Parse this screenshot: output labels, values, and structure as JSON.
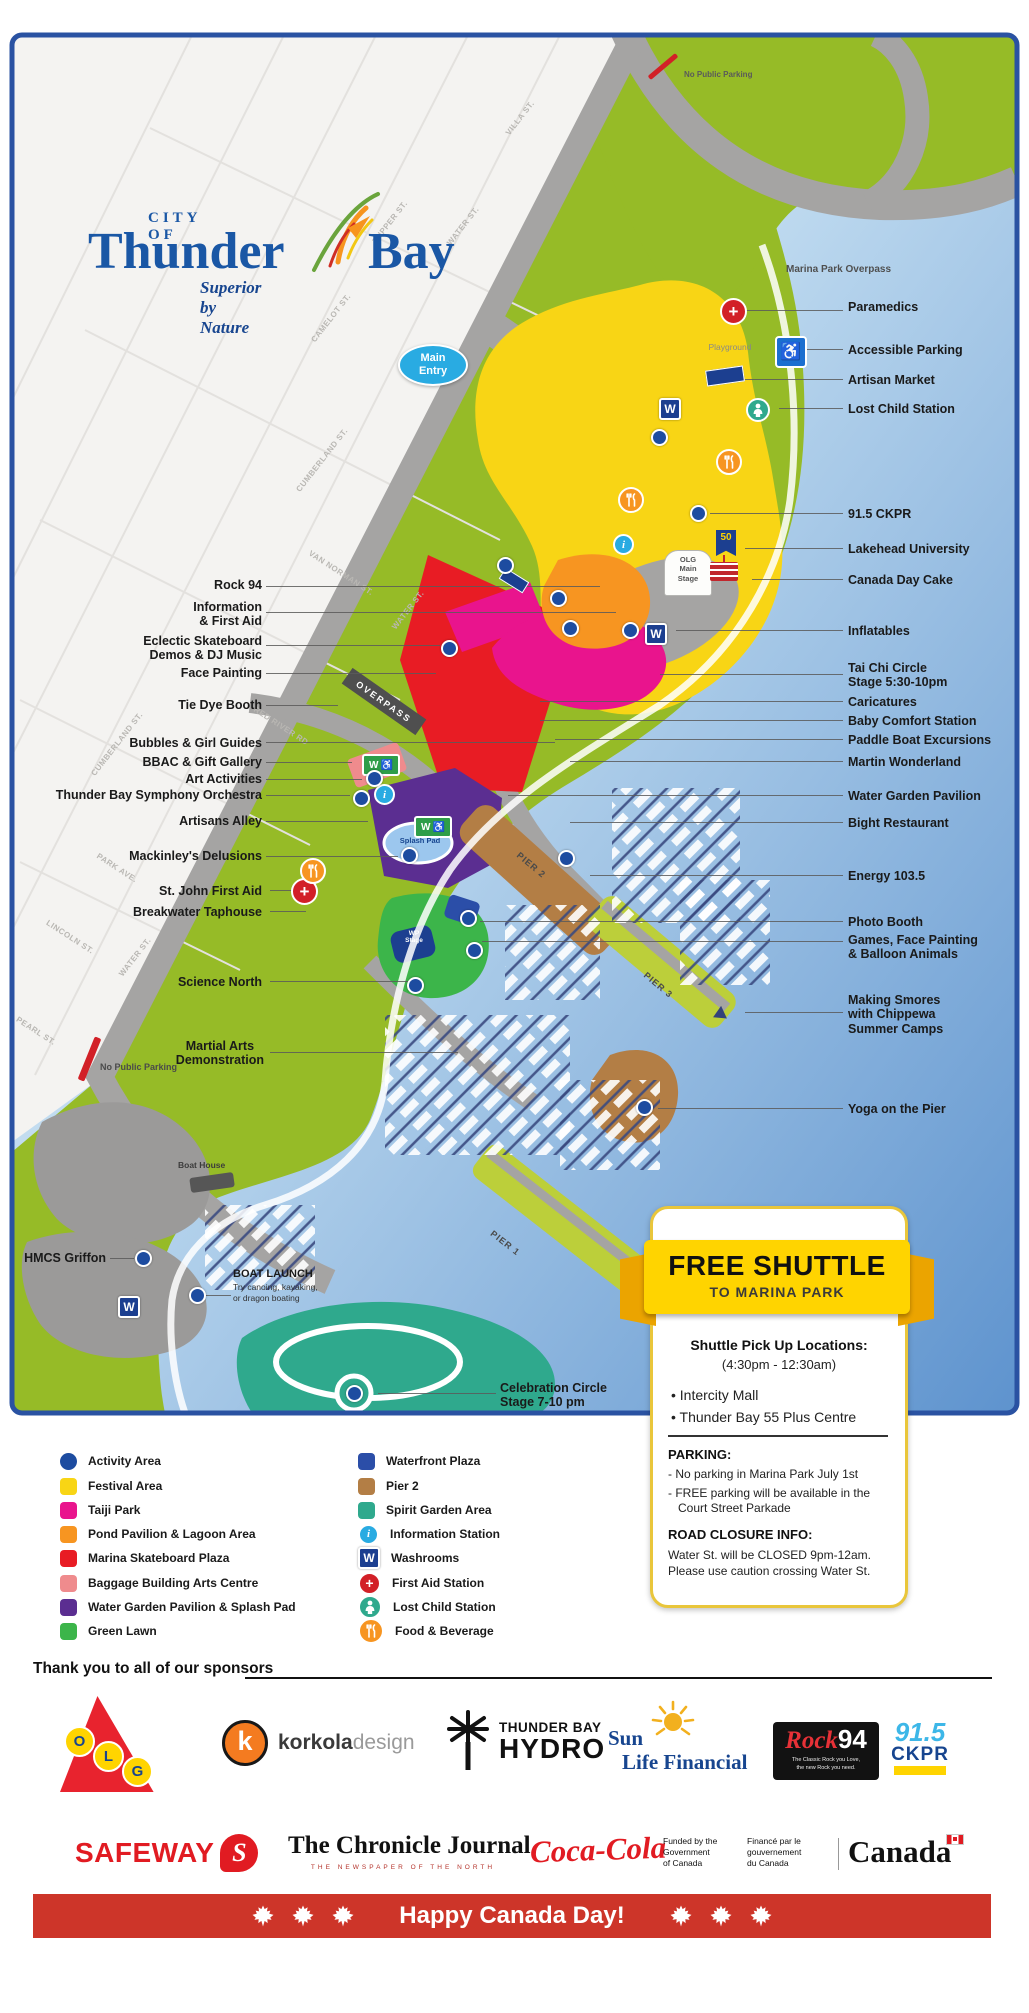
{
  "logo": {
    "city_of": "CITY OF",
    "thunder": "Thunder",
    "bay": "Bay",
    "tagline": "Superior by Nature"
  },
  "icons": {
    "washroom_letter": "W",
    "info_letter": "i",
    "accessible_symbol": "♿",
    "first_aid_symbol": "+",
    "flag_50": "50"
  },
  "map": {
    "no_public_parking_top": "No Public Parking",
    "no_public_parking_bottom": "No Public Parking",
    "marina_park_overpass": "Marina Park Overpass",
    "overpass_badge": "OVERPASS",
    "main_entry": "Main\nEntry",
    "playground": "Playground",
    "olg_main_stage": "OLG\nMain\nStage",
    "splash_pad": "Splash Pad",
    "wp_stage": "WP\nStage",
    "boat_house": "Boat House",
    "pier_1": "PIER 1",
    "pier_2": "PIER 2",
    "pier_3": "PIER 3",
    "boat_launch_title": "BOAT LAUNCH",
    "boat_launch_sub": "Try canoing, kayaking,\nor dragon boating",
    "streets": [
      "TUPPER ST.",
      "WATER ST.",
      "VILLA ST.",
      "CAMELOT ST.",
      "CUMBERLAND ST.",
      "VAN NORMAN ST.",
      "WATER ST.",
      "RED RIVER RD",
      "CUMBERLAND ST.",
      "PARK AVE.",
      "LINCOLN ST.",
      "WATER ST.",
      "PEARL ST."
    ],
    "left_labels": [
      "Rock 94",
      "Information\n& First Aid",
      "Eclectic Skateboard\nDemos & DJ Music",
      "Face Painting",
      "Tie Dye Booth",
      "Bubbles & Girl Guides",
      "BBAC & Gift Gallery",
      "Art Activities",
      "Thunder Bay Symphony Orchestra",
      "Artisans Alley",
      "Mackinley's Delusions",
      "St. John First Aid",
      "Breakwater Taphouse",
      "Science North",
      "Martial Arts\nDemonstration",
      "HMCS Griffon",
      "Celebration Circle\nStage 7-10 pm"
    ],
    "right_labels": [
      "Paramedics",
      "Accessible Parking",
      "Artisan Market",
      "Lost Child Station",
      "91.5 CKPR",
      "Lakehead University",
      "Canada Day Cake",
      "Inflatables",
      "Tai Chi Circle\nStage 5:30-10pm",
      "Caricatures",
      "Baby Comfort Station",
      "Paddle Boat Excursions",
      "Martin Wonderland",
      "Water Garden Pavilion",
      "Bight Restaurant",
      "Energy 103.5",
      "Photo Booth",
      "Games, Face Painting\n& Balloon Animals",
      "Making Smores\nwith Chippewa\nSummer Camps",
      "Yoga on the Pier"
    ]
  },
  "legend": {
    "col1": [
      {
        "label": "Activity Area",
        "color": "#1d4ca0",
        "shape": "circle"
      },
      {
        "label": "Festival Area",
        "color": "#f8d515",
        "shape": "square"
      },
      {
        "label": "Taiji Park",
        "color": "#e9148d",
        "shape": "square"
      },
      {
        "label": "Pond Pavilion & Lagoon Area",
        "color": "#f79521",
        "shape": "square"
      },
      {
        "label": "Marina Skateboard Plaza",
        "color": "#e81c24",
        "shape": "square"
      },
      {
        "label": "Baggage Building Arts Centre",
        "color": "#ef8b8d",
        "shape": "square"
      },
      {
        "label": "Water Garden Pavilion & Splash Pad",
        "color": "#5b2e91",
        "shape": "square"
      },
      {
        "label": "Green Lawn",
        "color": "#3cb54a",
        "shape": "square"
      }
    ],
    "col2": [
      {
        "label": "Waterfront Plaza",
        "color": "#2b4ea8",
        "shape": "square"
      },
      {
        "label": "Pier 2",
        "color": "#b37e45",
        "shape": "square"
      },
      {
        "label": "Spirit Garden Area",
        "color": "#2fa98d",
        "shape": "square"
      },
      {
        "label": "Information Station",
        "icon": "info-icon"
      },
      {
        "label": "Washrooms",
        "icon": "washroom-icon"
      },
      {
        "label": "First Aid Station",
        "icon": "first-aid-icon"
      },
      {
        "label": "Lost Child Station",
        "icon": "lost-child-icon"
      },
      {
        "label": "Food & Beverage",
        "icon": "food-icon"
      }
    ]
  },
  "shuttle": {
    "banner_title": "FREE SHUTTLE",
    "banner_subtitle": "TO MARINA PARK",
    "pickup_title": "Shuttle Pick Up Locations:",
    "pickup_hours": "(4:30pm  -  12:30am)",
    "locations": [
      "• Intercity Mall",
      "• Thunder Bay 55 Plus Centre"
    ],
    "parking_title": "PARKING:",
    "parking_items": [
      "-  No parking in Marina Park July 1st",
      "-  FREE parking will be available in the Court Street Parkade"
    ],
    "road_closure_title": "ROAD CLOSURE INFO:",
    "road_closure_lines": "Water St. will be CLOSED 9pm-12am.\nPlease use caution crossing Water St."
  },
  "sponsors": {
    "heading": "Thank you to all of our sponsors",
    "olg": {
      "o": "O",
      "l": "L",
      "g": "G"
    },
    "korkola": {
      "k": "k",
      "bold": "korkola",
      "light": "design"
    },
    "hydro": {
      "top": "THUNDER BAY",
      "bottom": "HYDRO"
    },
    "sunlife": {
      "sun": "Sun",
      "rest": "Life Financial"
    },
    "rock": {
      "script": "Rock",
      "number": "94",
      "tagline": "The Classic Rock you Love,\nthe new Rock you need."
    },
    "ckpr": {
      "number": "91.5",
      "letters": "CKPR"
    },
    "safeway": {
      "name": "SAFEWAY",
      "mark": "S"
    },
    "chronicle": {
      "name": "The Chronicle Journal",
      "subtitle": "THE NEWSPAPER OF THE NORTH"
    },
    "coke": "Coca-Cola",
    "canada_funding": {
      "en": "Funded by the\nGovernment\nof Canada",
      "fr": "Financé par le\ngouvernement\ndu Canada",
      "wordmark": "Canada"
    }
  },
  "footer": {
    "message": "Happy Canada Day!"
  }
}
